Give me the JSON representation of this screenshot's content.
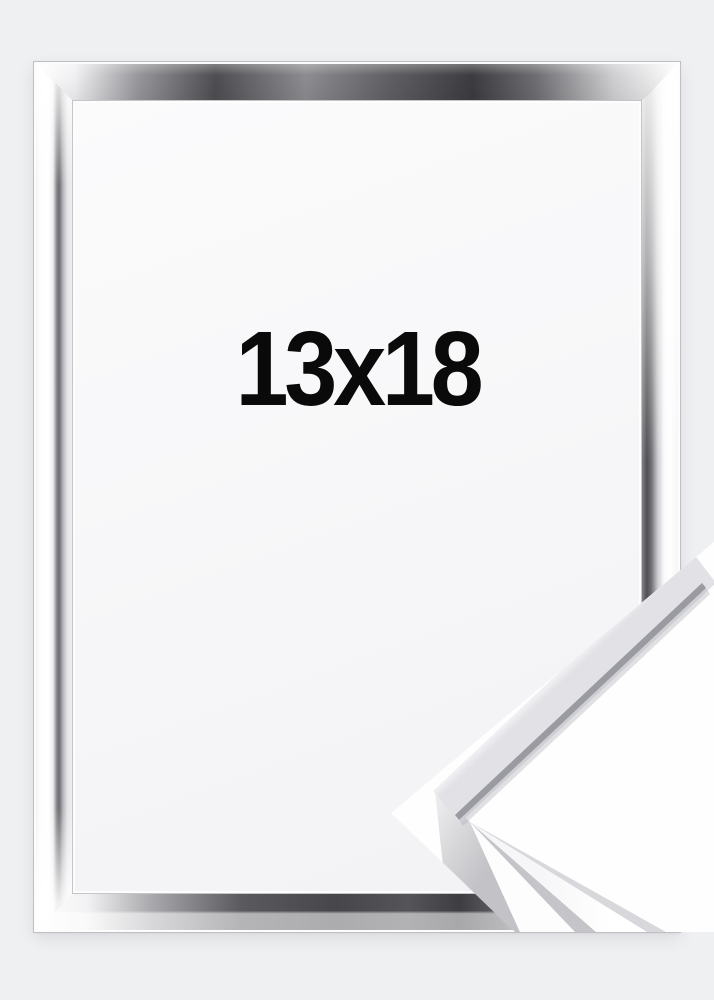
{
  "product": {
    "size_label": "13x18",
    "frame_finish": "silver",
    "colors": {
      "page_background": "#eff0f2",
      "label_text": "#0a0a0b",
      "opening_background": "#fbfbfc",
      "metal_light": "#ffffff",
      "metal_mid": "#8a8a8e",
      "metal_dark": "#3c3c40"
    }
  }
}
